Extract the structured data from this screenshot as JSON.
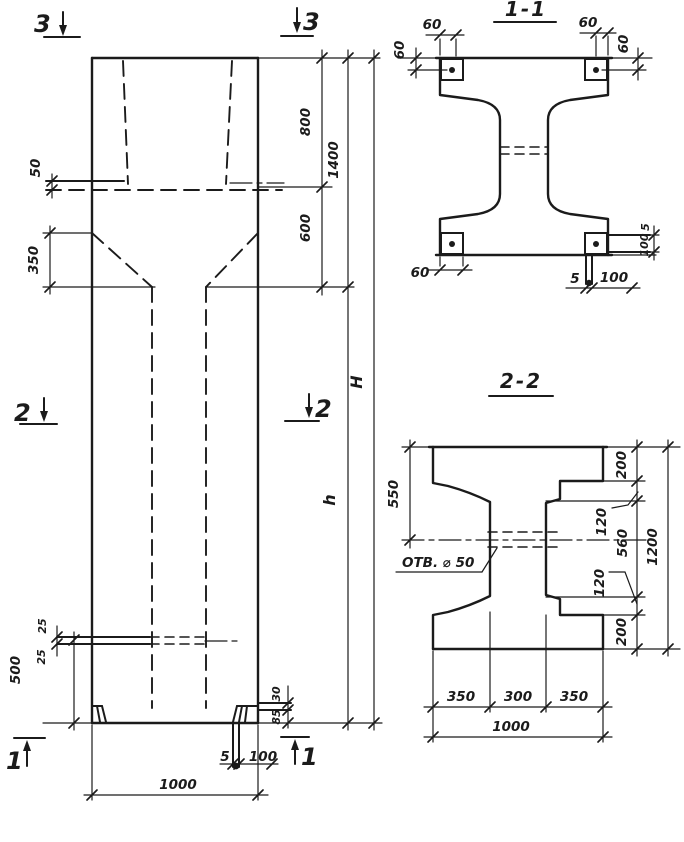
{
  "style": {
    "ink": "#1b1b1b",
    "bg": "#ffffff"
  },
  "elevation": {
    "markers": {
      "top_left": "3",
      "top_right": "3",
      "mid_left": "2",
      "mid_right": "2",
      "bottom_left": "1",
      "bottom_right": "1"
    },
    "dims": {
      "ledge_50": "50",
      "taper_350": "350",
      "top_800": "800",
      "total_1400": "1400",
      "mid_600": "600",
      "shaft_h": "h",
      "height_H": "H",
      "slot_25a": "25",
      "slot_25b": "25",
      "base_500": "500",
      "plate_30": "30",
      "plate_85": "85",
      "plate_5": "5",
      "plate_100": "100",
      "width_1000": "1000"
    }
  },
  "section11": {
    "title": "1-1",
    "dims": {
      "tl_60h": "60",
      "tl_60v": "60",
      "tr_60h": "60",
      "tr_60v": "60",
      "bl_60": "60",
      "r_5": "5",
      "r_100": "100",
      "b_5": "5",
      "b_100": "100"
    }
  },
  "section22": {
    "title": "2-2",
    "dims": {
      "left_550": "550",
      "hole": "ОТВ. ⌀ 50",
      "r_200t": "200",
      "r_120t": "120",
      "r_560": "560",
      "r_120b": "120",
      "r_200b": "200",
      "r_1200": "1200",
      "b_350l": "350",
      "b_300": "300",
      "b_350r": "350",
      "b_1000": "1000"
    }
  }
}
